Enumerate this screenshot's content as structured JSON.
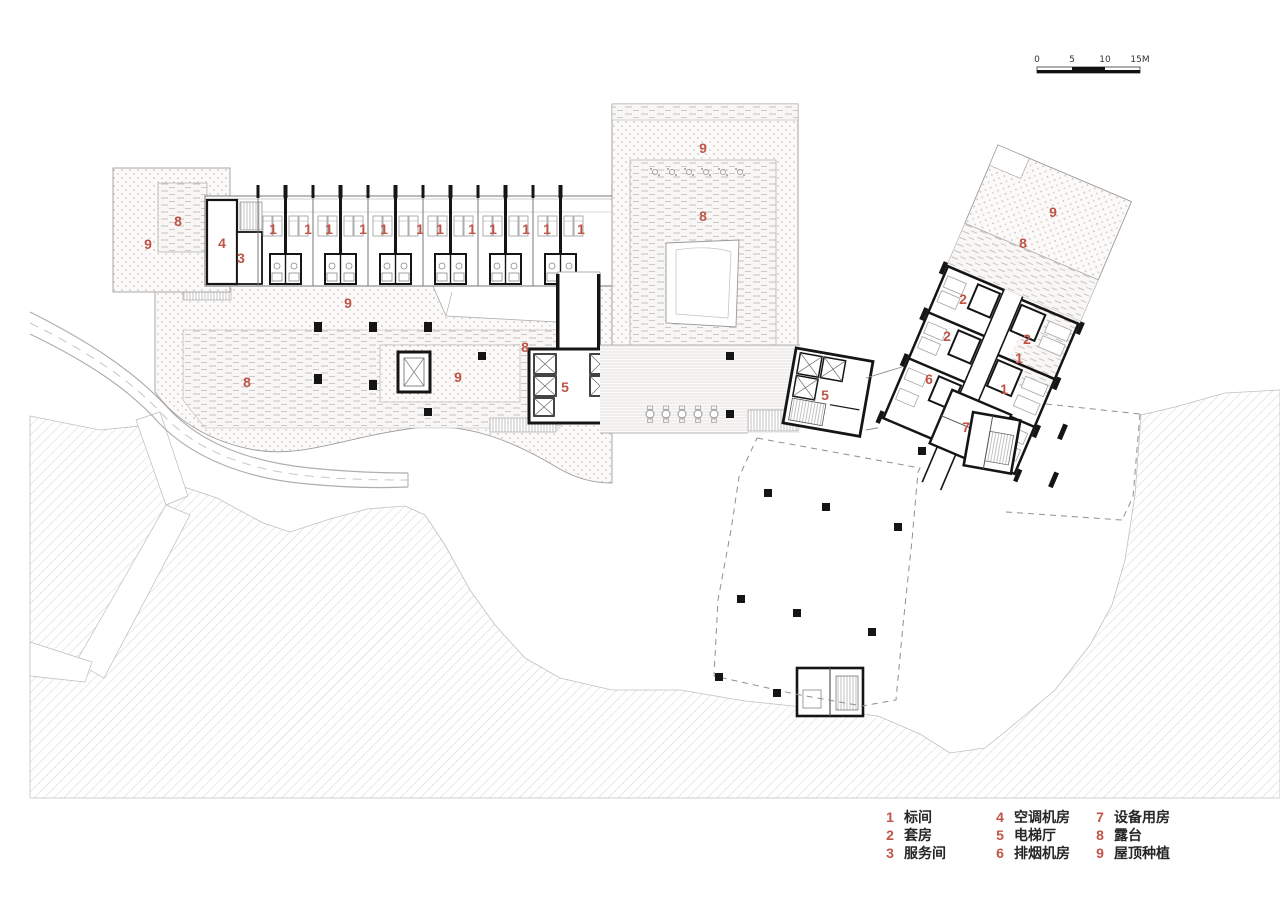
{
  "page": {
    "background": "#ffffff",
    "label_color": "#bf5447",
    "wall_color": "#151515"
  },
  "scale_bar": {
    "ticks": [
      "0",
      "5",
      "10",
      "15M"
    ]
  },
  "plan": {
    "labels": [
      {
        "t": "9",
        "x": 148,
        "y": 249
      },
      {
        "t": "8",
        "x": 178,
        "y": 226
      },
      {
        "t": "4",
        "x": 222,
        "y": 248
      },
      {
        "t": "3",
        "x": 241,
        "y": 263
      },
      {
        "t": "1",
        "x": 273,
        "y": 234
      },
      {
        "t": "1",
        "x": 308,
        "y": 234
      },
      {
        "t": "1",
        "x": 329,
        "y": 234
      },
      {
        "t": "1",
        "x": 363,
        "y": 234
      },
      {
        "t": "1",
        "x": 384,
        "y": 234
      },
      {
        "t": "1",
        "x": 420,
        "y": 234
      },
      {
        "t": "1",
        "x": 440,
        "y": 234
      },
      {
        "t": "1",
        "x": 472,
        "y": 234
      },
      {
        "t": "1",
        "x": 493,
        "y": 234
      },
      {
        "t": "1",
        "x": 526,
        "y": 234
      },
      {
        "t": "1",
        "x": 547,
        "y": 234
      },
      {
        "t": "1",
        "x": 581,
        "y": 234
      },
      {
        "t": "9",
        "x": 348,
        "y": 308
      },
      {
        "t": "8",
        "x": 247,
        "y": 387
      },
      {
        "t": "9",
        "x": 458,
        "y": 382
      },
      {
        "t": "8",
        "x": 525,
        "y": 352
      },
      {
        "t": "5",
        "x": 565,
        "y": 392
      },
      {
        "t": "9",
        "x": 703,
        "y": 153
      },
      {
        "t": "8",
        "x": 703,
        "y": 221
      },
      {
        "t": "9",
        "x": 1053,
        "y": 217
      },
      {
        "t": "8",
        "x": 1023,
        "y": 248
      },
      {
        "t": "2",
        "x": 963,
        "y": 304
      },
      {
        "t": "2",
        "x": 947,
        "y": 341
      },
      {
        "t": "2",
        "x": 1027,
        "y": 344
      },
      {
        "t": "1",
        "x": 1019,
        "y": 363
      },
      {
        "t": "6",
        "x": 929,
        "y": 384
      },
      {
        "t": "1",
        "x": 1004,
        "y": 394
      },
      {
        "t": "5",
        "x": 825,
        "y": 400
      },
      {
        "t": "7",
        "x": 966,
        "y": 432
      }
    ]
  },
  "legend": {
    "number_color": "#bf5447",
    "text_color": "#262626",
    "columns": [
      {
        "items": [
          {
            "num": "1",
            "label": "标间"
          },
          {
            "num": "2",
            "label": "套房"
          },
          {
            "num": "3",
            "label": "服务间"
          }
        ]
      },
      {
        "items": [
          {
            "num": "4",
            "label": "空调机房"
          },
          {
            "num": "5",
            "label": "电梯厅"
          },
          {
            "num": "6",
            "label": "排烟机房"
          }
        ]
      },
      {
        "items": [
          {
            "num": "7",
            "label": "设备用房"
          },
          {
            "num": "8",
            "label": "露台"
          },
          {
            "num": "9",
            "label": "屋顶种植"
          }
        ]
      }
    ]
  }
}
